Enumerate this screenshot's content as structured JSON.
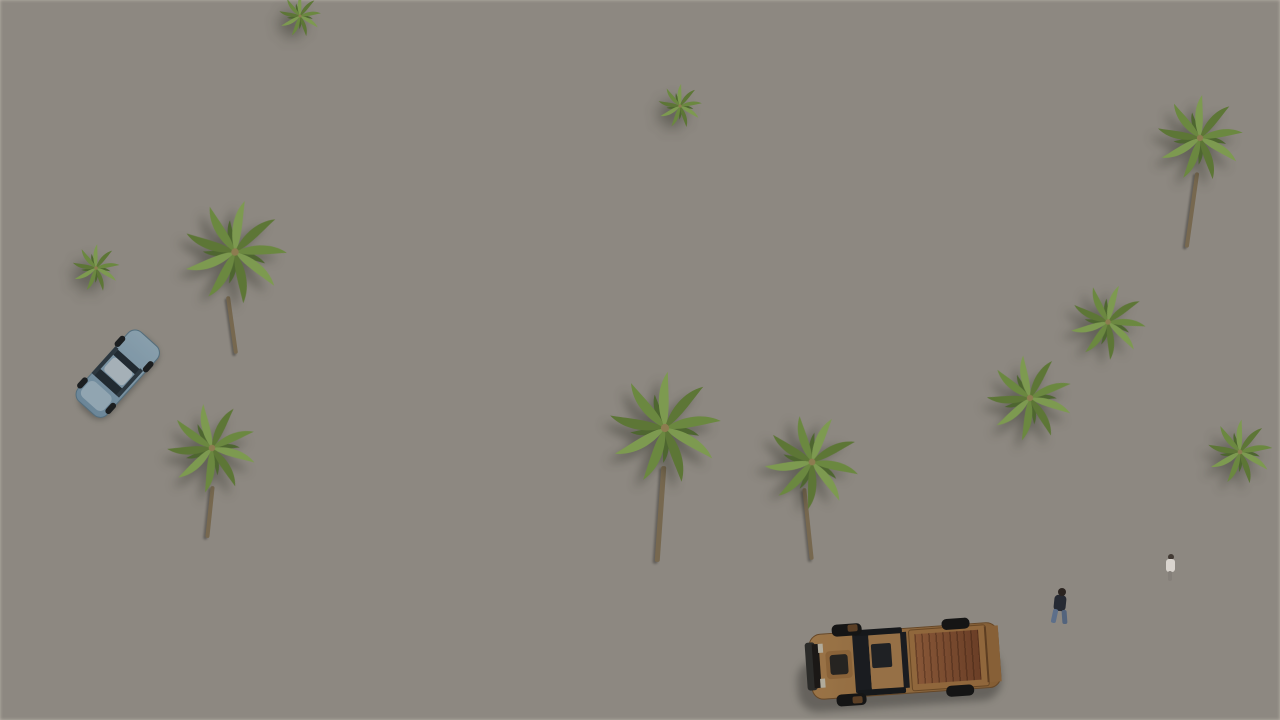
{
  "scene": {
    "title": "Aerial 3D architectural render of a modern white villa development",
    "camera": "high-angle three-quarter aerial view, sunlight from the right casting shadows to the lower-left",
    "setting": "new-build Mediterranean residential complex with flat-roofed white villas, private pools, palm trees and clipped hedges beside a grey street",
    "objects": [
      {
        "name": "backdrop-terrain",
        "desc": "plain ungraded taupe ground filling the upper right",
        "color": "#a8a19b"
      },
      {
        "name": "distant-villa-row",
        "desc": "diagonal rows of white flat-roofed villas with light grey roofs, white parapets, sandstone accent walls and dark grey chimneys",
        "color": "#f3f2ee"
      },
      {
        "name": "hero-villa",
        "desc": "central two-storey semi-detached villa, white render, full-height glazing with curtains, stone-clad fins, large grey gravel roof",
        "color": "#f6f5f2"
      },
      {
        "name": "right-villa",
        "desc": "neighbouring villa with roof solarium, straw parasol and white deck",
        "color": "#f1f0ed"
      },
      {
        "name": "far-right-villa",
        "desc": "foreground-right villa with sandstone feature wall and picture window",
        "color": "#ccb68e"
      },
      {
        "name": "solarium-stairs",
        "desc": "white external stair between parapets",
        "color": "#f2f1ed"
      },
      {
        "name": "big-pool",
        "desc": "rectangular mosaic-lined swimming pool",
        "color": "#9cb3c2"
      },
      {
        "name": "pool-deck",
        "desc": "cream tiled pool surround",
        "color": "#dcd5c5"
      },
      {
        "name": "terrace",
        "desc": "tiled ground-floor terrace of the hero villa",
        "color": "#d9d3c5"
      },
      {
        "name": "outdoor-sofa",
        "desc": "white L-shaped lounge sofa with teal and white cushions",
        "color": "#8fb9ba"
      },
      {
        "name": "dining-parasol",
        "desc": "square beige canvas parasol over outdoor dining table",
        "color": "#d9cfb4"
      },
      {
        "name": "dining-set",
        "desc": "wooden table with rattan chairs",
        "color": "#b08954"
      },
      {
        "name": "straw-parasols",
        "desc": "three round thatched straw parasols",
        "color": "#c9a86e"
      },
      {
        "name": "orange-parasol",
        "desc": "small terracotta-orange parasol in a distant garden",
        "color": "#bf5a38"
      },
      {
        "name": "sun-loungers",
        "desc": "white slatted loungers beside parasols and pool",
        "color": "#f1f1ee"
      },
      {
        "name": "palm-trees",
        "desc": "eleven fan palms of varying size across the gardens and backdrop",
        "color": "#5d7636"
      },
      {
        "name": "hedges",
        "desc": "clipped dark-green cypress hedges dividing every plot and lining the boundary wall",
        "color": "#45522e"
      },
      {
        "name": "lawns",
        "desc": "small artificial-grass panels around the pool",
        "color": "#6e8048"
      },
      {
        "name": "gravel-yard",
        "desc": "dark volcanic gravel front garden of the hero villa",
        "color": "#403e3a"
      },
      {
        "name": "stepping-stones",
        "desc": "pale concrete pads crossing the gravel to the terrace",
        "color": "#d2cdc4"
      },
      {
        "name": "street-lamp",
        "desc": "small garden lamp post in the gravel yard",
        "color": "#3b3b39"
      },
      {
        "name": "boundary-wall",
        "desc": "low white rendered perimeter wall along the street",
        "color": "#f5f4f0"
      },
      {
        "name": "gates",
        "desc": "dark brown entrance and garage gates set into the wall",
        "color": "#3a2f24"
      },
      {
        "name": "sidewalk",
        "desc": "light aggregate footpath strip above the road",
        "color": "#bcb6aa"
      },
      {
        "name": "road",
        "desc": "smooth grey asphalt street across the foreground",
        "color": "#9a9793"
      },
      {
        "name": "driveway",
        "desc": "pale paved drive entering the far-right plot",
        "color": "#d6d0c4"
      },
      {
        "name": "pickup-truck",
        "desc": "sand-bronze double-cab pickup with open cargo bed, parked on the road",
        "color": "#c8955c"
      },
      {
        "name": "blue-car",
        "desc": "light-blue saloon parked on the left inner street",
        "color": "#a9c9df"
      },
      {
        "name": "distant-cars",
        "desc": "grey and red cars glimpsed behind the upper hedges",
        "color": "#9aa1a4"
      },
      {
        "name": "pedestrian",
        "desc": "man in dark top and jeans walking on the road, casting a long shadow",
        "color": "#262a33"
      },
      {
        "name": "resident",
        "desc": "small figure standing at the far-right doorway",
        "color": "#d9d4ce"
      },
      {
        "name": "garage-door",
        "desc": "dark recessed garage opening at lower right",
        "color": "#241d16"
      },
      {
        "name": "bougainvillea",
        "desc": "magenta flowering shrubs at upper left and upper right",
        "color": "#c05e8c"
      },
      {
        "name": "chimneys",
        "desc": "dark grey flue boxes on several roofs",
        "color": "#55534f"
      }
    ]
  },
  "palette": {
    "bg1": "#97908a",
    "bg2": "#a8a19b",
    "bg3": "#b7b1aa",
    "sand": "#cfc8ba",
    "street": "#d4cdc0",
    "road1": "#a6a29e",
    "road2": "#8e8b87",
    "sidewalk": "#bcb6aa",
    "driveway": "#d6d0c4",
    "wall-top": "#f5f4f0",
    "wall-face": "#e8e6e1",
    "roof": "#c9c6c1",
    "roof-light": "#d4d1cc",
    "parapet": "#f3f2ee",
    "white-lit": "#f6f5f2",
    "white-shade": "#e4e2de",
    "white-deep": "#d6d4d0",
    "glass": "#3e4246",
    "curtain-a": "#ddd9d1",
    "curtain-b": "#bdb9b1",
    "stone-a": "#ccb68e",
    "stone-b": "#a8906a",
    "hedge-a": "#45522e",
    "hedge-b": "#5f7239",
    "lawn-a": "#6e8048",
    "lawn-b": "#7d9054",
    "gravel-a": "#403e3a",
    "pool-a": "#c6d6de",
    "pool-b": "#9cb3c2",
    "deck": "#dcd5c5",
    "tile": "#d9d3c5",
    "straw-a": "#c9a86e",
    "straw-b": "#9e7e4a",
    "canvas": "#d9cfb4",
    "wood": "#b08954",
    "rattan": "#9a7a4e",
    "teal": "#8fb9ba",
    "truck-body": "#c8955c",
    "truck-dark": "#a9763f",
    "truck-bed": "#a86a41",
    "tire": "#1c1c1c",
    "car-body": "#a9c9df",
    "car-glass": "#2c3942",
    "gate-a": "#3a2f24",
    "gate-b": "#241d16",
    "flower": "#c05e8c",
    "parasol-orange": "#bf5a38",
    "trunk": "#77684f",
    "chimney": "#55534f",
    "glassrail": "#dfe7e8"
  }
}
